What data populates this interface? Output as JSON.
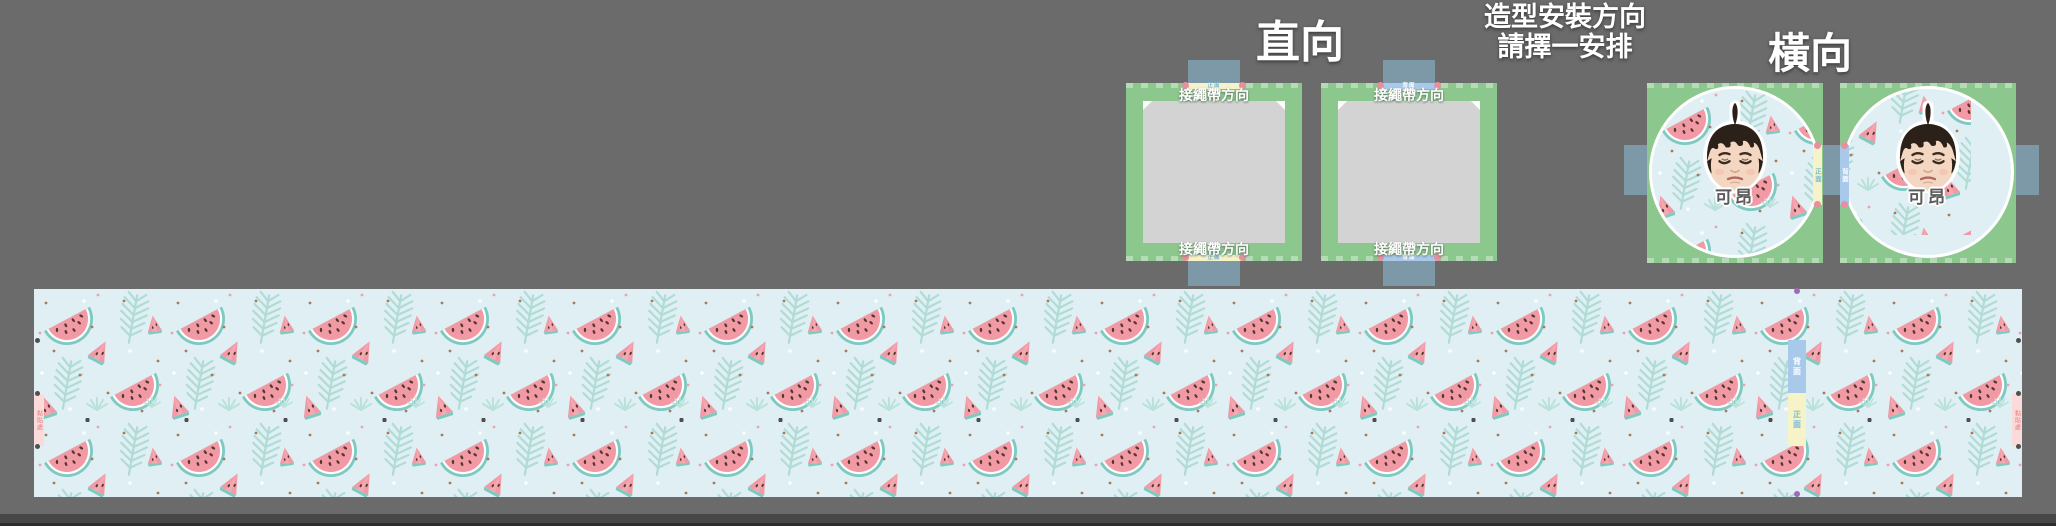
{
  "header": {
    "portrait_title": "直向",
    "instruction_line1": "造型安裝方向",
    "instruction_line2": "請擇一安排",
    "landscape_title": "橫向"
  },
  "labels": {
    "strap_direction": "接繩帶方向",
    "front": "正面",
    "back": "背面",
    "glue": "黏貼處",
    "name": "可昂"
  },
  "colors": {
    "background": "#6b6b6b",
    "panel_green": "#8cc88e",
    "tab_blue_gray": "#7d98a6",
    "placeholder_gray": "#d3d3d3",
    "front_marker_yellow": "#f7f3c8",
    "back_marker_blue": "#a9c9ea",
    "marker_dot_pink": "#e78f9f",
    "strip_background": "#dfeff3",
    "watermelon_pink": "#f19aa5",
    "rind_teal": "#7ecac2",
    "leaf_teal": "#aedcd4",
    "purple_dot": "#9b6bb5"
  }
}
